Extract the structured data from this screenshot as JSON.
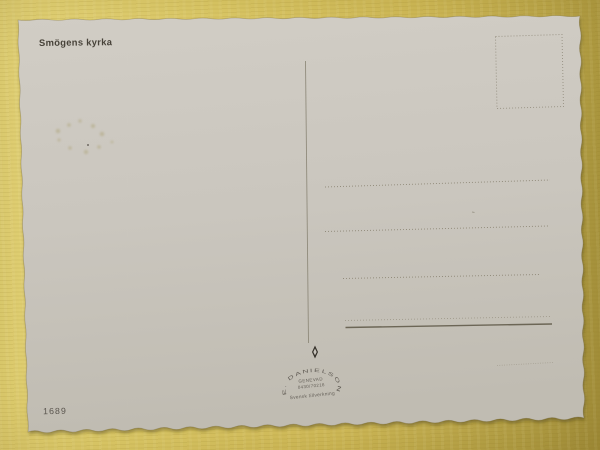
{
  "postcard": {
    "caption": "Smögens kyrka",
    "serial_number": "1689",
    "publisher": {
      "arc_text": "E. DANIELSON AB",
      "town": "GENEVAD",
      "phone": "0430/70216",
      "note": "Svensk tillverkning"
    }
  },
  "colors": {
    "background": "#d9c565",
    "paper": "#cac6be",
    "ink": "#45413a",
    "rule": "#847e6e"
  },
  "icons": {
    "publisher_mark": "diamond-icon"
  }
}
